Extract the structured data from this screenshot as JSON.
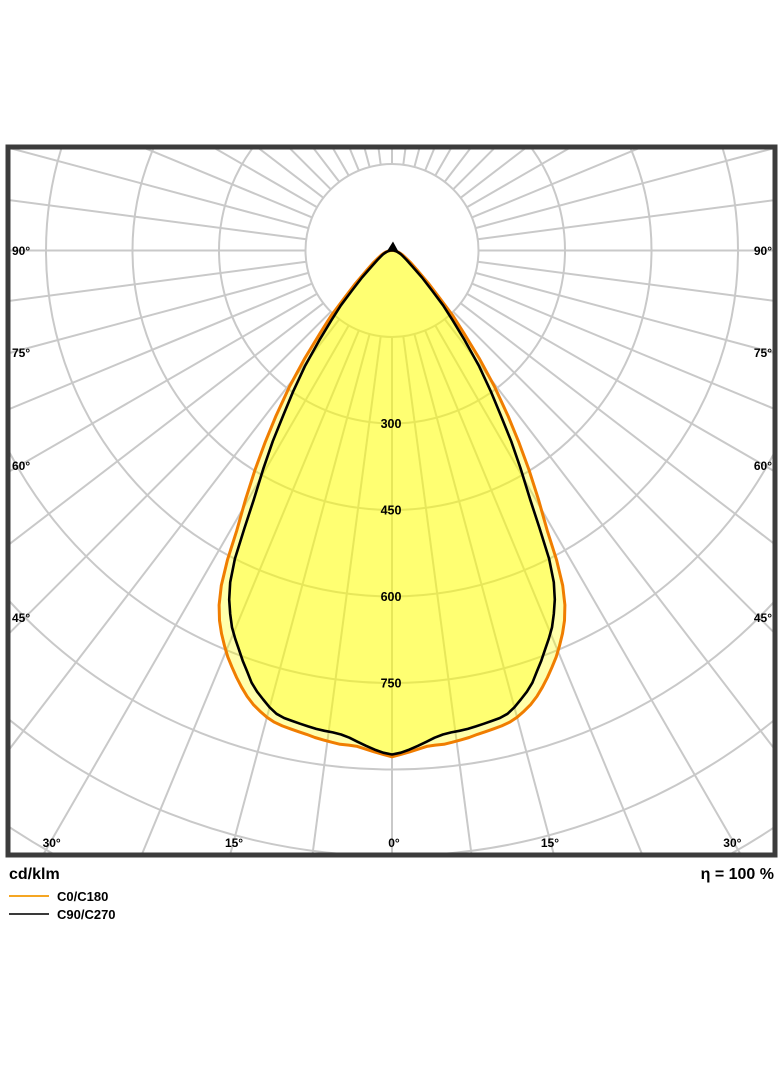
{
  "chart_data": {
    "type": "polar_photometric",
    "title": "Luminous intensity distribution curve",
    "unit_label": "cd/klm",
    "efficiency_label": "η = 100 %",
    "angle_convention": "0° = nadir (straight down), 90° = horizontal",
    "grid": {
      "ring_step_cd_klm": 150,
      "ring_count": 9,
      "spoke_step_deg": 7.5,
      "labeled_step_deg": 15,
      "inner_blank_radius_cd_klm": 150
    },
    "radial_axis_values": [
      300,
      450,
      600,
      750
    ],
    "angle_labels_left": [
      {
        "deg": 90,
        "text": "90°"
      },
      {
        "deg": 75,
        "text": "75°"
      },
      {
        "deg": 60,
        "text": "60°"
      },
      {
        "deg": 45,
        "text": "45°"
      }
    ],
    "angle_labels_right": [
      {
        "deg": 90,
        "text": "90°"
      },
      {
        "deg": 75,
        "text": "75°"
      },
      {
        "deg": 60,
        "text": "60°"
      },
      {
        "deg": 45,
        "text": "45°"
      }
    ],
    "angle_labels_bottom": [
      {
        "deg": -30,
        "text": "30°"
      },
      {
        "deg": -15,
        "text": "15°"
      },
      {
        "deg": 0,
        "text": "0°"
      },
      {
        "deg": 15,
        "text": "15°"
      },
      {
        "deg": 30,
        "text": "30°"
      }
    ],
    "series": [
      {
        "name": "C0/C180",
        "color": "#F07D00",
        "stroke_width": 3,
        "symmetric": true,
        "points_deg_cdklm": [
          [
            0,
            878
          ],
          [
            1,
            874
          ],
          [
            2,
            870
          ],
          [
            3,
            866
          ],
          [
            4,
            862
          ],
          [
            5,
            861
          ],
          [
            6,
            861
          ],
          [
            7,
            859
          ],
          [
            8,
            857
          ],
          [
            9,
            855
          ],
          [
            10,
            852
          ],
          [
            11,
            850
          ],
          [
            12,
            848
          ],
          [
            13,
            846
          ],
          [
            14,
            843
          ],
          [
            15,
            838
          ],
          [
            16,
            831
          ],
          [
            17,
            823
          ],
          [
            18,
            813
          ],
          [
            19,
            801
          ],
          [
            20,
            788
          ],
          [
            21,
            774
          ],
          [
            22,
            760
          ],
          [
            23,
            744
          ],
          [
            24,
            727
          ],
          [
            25,
            708
          ],
          [
            26,
            684
          ],
          [
            27,
            652
          ],
          [
            28,
            608
          ],
          [
            29,
            555
          ],
          [
            30.5,
            500
          ],
          [
            32,
            448
          ],
          [
            33.5,
            398
          ],
          [
            35,
            352
          ],
          [
            37,
            295
          ],
          [
            39,
            240
          ],
          [
            41,
            190
          ],
          [
            43,
            155
          ],
          [
            45,
            118
          ],
          [
            48,
            85
          ],
          [
            52,
            56
          ],
          [
            57,
            38
          ],
          [
            62,
            27
          ],
          [
            68,
            19
          ],
          [
            75,
            12
          ],
          [
            82,
            7
          ],
          [
            90,
            3
          ]
        ]
      },
      {
        "name": "C90/C270",
        "color": "#000000",
        "stroke_width": 2.6,
        "symmetric": true,
        "points_deg_cdklm": [
          [
            0,
            874
          ],
          [
            1,
            871
          ],
          [
            2,
            866
          ],
          [
            3,
            860
          ],
          [
            4,
            854
          ],
          [
            5,
            848
          ],
          [
            6,
            844
          ],
          [
            7,
            842
          ],
          [
            8,
            841
          ],
          [
            9,
            840
          ],
          [
            10,
            838
          ],
          [
            11,
            836
          ],
          [
            12,
            834
          ],
          [
            13,
            832
          ],
          [
            14,
            828
          ],
          [
            15,
            820
          ],
          [
            16,
            810
          ],
          [
            17,
            800
          ],
          [
            18,
            788
          ],
          [
            19,
            772
          ],
          [
            20,
            757
          ],
          [
            21,
            741
          ],
          [
            22,
            726
          ],
          [
            23,
            710
          ],
          [
            24,
            690
          ],
          [
            25,
            668
          ],
          [
            26,
            640
          ],
          [
            27,
            600
          ],
          [
            28,
            545
          ],
          [
            29,
            495
          ],
          [
            30.5,
            440
          ],
          [
            32,
            390
          ],
          [
            33.5,
            340
          ],
          [
            35,
            300
          ],
          [
            37,
            250
          ],
          [
            39,
            200
          ],
          [
            41,
            160
          ],
          [
            43,
            130
          ],
          [
            45,
            98
          ],
          [
            48,
            70
          ],
          [
            52,
            45
          ],
          [
            57,
            30
          ],
          [
            62,
            22
          ],
          [
            68,
            16
          ],
          [
            75,
            10
          ],
          [
            82,
            6
          ],
          [
            90,
            3
          ]
        ]
      }
    ],
    "legend": [
      {
        "label": "C0/C180",
        "color": "#F5A623"
      },
      {
        "label": "C90/C270",
        "color": "#3A3A3A"
      }
    ],
    "colors": {
      "grid": "#C9C9C9",
      "frame": "#3C3C3C",
      "curve_fill": "rgba(255,255,0,0.33)",
      "background": "#FFFFFF",
      "text": "#000000"
    }
  }
}
